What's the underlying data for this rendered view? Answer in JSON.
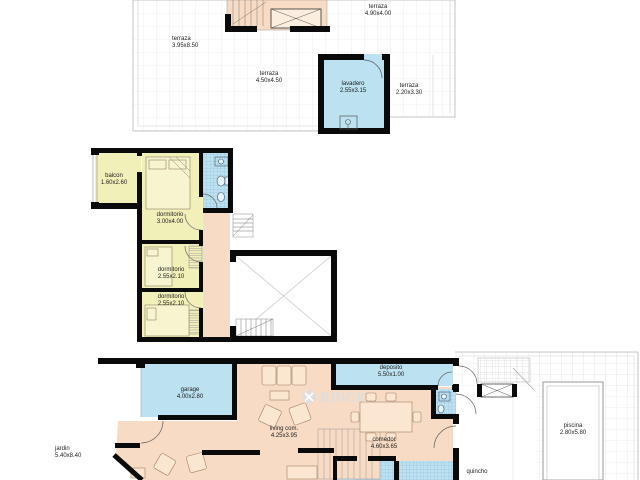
{
  "document": {
    "type": "architectural floor plan set",
    "sheets": [
      "roof terrace plan",
      "upper floor plan",
      "ground floor plan"
    ]
  },
  "watermark": {
    "brand": "BRICK",
    "icon": "brick-diamond-logo"
  },
  "colors": {
    "room_social_salmon": "#f8dbc4",
    "room_bedroom_yellow": "#f2f0b9",
    "room_service_blue": "#bce1f1",
    "wall_black": "#0a0a0a",
    "tile_grid_gray": "#e2e2e2",
    "watermark_gray": "#dedede"
  },
  "floors": {
    "roof_terrace_plan": {
      "rooms": {
        "terraza_left": {
          "name": "terraza",
          "dims": "3.95x8.50"
        },
        "terraza_top_right": {
          "name": "terraza",
          "dims": "4.90x4.00"
        },
        "terraza_center": {
          "name": "terraza",
          "dims": "4.50x4.50"
        },
        "lavadero": {
          "name": "lavadero",
          "dims": "2.55x3.15"
        },
        "terraza_right": {
          "name": "terraza",
          "dims": "2.20x3.30"
        }
      }
    },
    "upper_floor_plan": {
      "rooms": {
        "balcon": {
          "name": "balcon",
          "dims": "1.60x2.60"
        },
        "dormitorio_1": {
          "name": "dormitorio",
          "dims": "3.00x4.00"
        },
        "dormitorio_2": {
          "name": "dormitorio",
          "dims": "2.55x2.10"
        },
        "dormitorio_3": {
          "name": "dormitorio",
          "dims": "2.55x2.10"
        }
      }
    },
    "ground_floor_plan": {
      "rooms": {
        "garage": {
          "name": "garage",
          "dims": "4.00x2.80"
        },
        "deposito": {
          "name": "deposito",
          "dims": "5.50x1.00"
        },
        "living": {
          "name": "living com.",
          "dims": "4.25x3.95"
        },
        "comedor": {
          "name": "comedor",
          "dims": "4.60x3.65"
        },
        "piscina": {
          "name": "piscina",
          "dims": "2.80x5.80"
        },
        "quincho": {
          "name": "quincho",
          "dims": ""
        },
        "jardin": {
          "name": "jardin",
          "dims": "5.40x8.40"
        }
      }
    }
  }
}
